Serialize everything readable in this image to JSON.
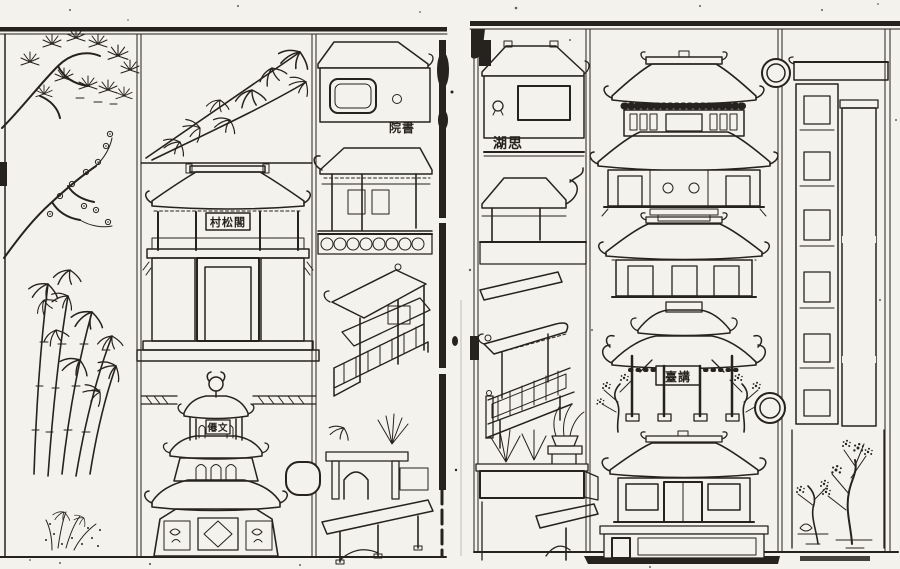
{
  "colors": {
    "paper": "#f4f2ed",
    "ink": "#262220",
    "smudge": "#b9b5ae"
  },
  "pages": {
    "left": {
      "name_plaques": {
        "pavilion": "村松閣",
        "pagoda": "僊文",
        "study": "院書"
      }
    },
    "right": {
      "name_plaques": {
        "hall": "湖思",
        "archway": "臺講"
      }
    }
  }
}
